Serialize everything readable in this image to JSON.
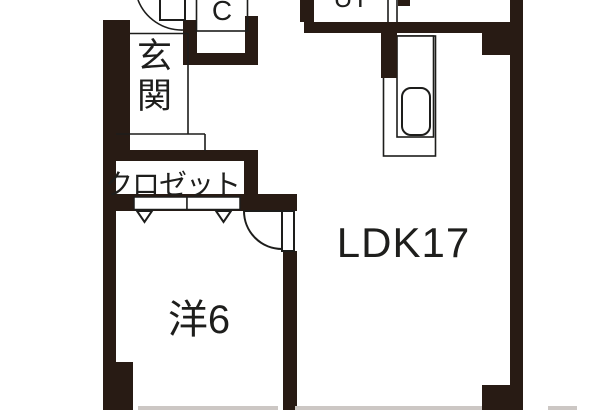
{
  "title": "apartment-floor-plan",
  "colors": {
    "wall": "#281b14",
    "line": "#1d1d1b",
    "window": "#ccc7c4",
    "floor": "#ffffff"
  },
  "rooms": {
    "genkan": {
      "label": "玄関"
    },
    "closet_c": {
      "label": "C"
    },
    "utility": {
      "label": "UT"
    },
    "closet": {
      "label": "クロゼット"
    },
    "western_room": {
      "label": "洋6"
    },
    "ldk": {
      "label": "LDK17"
    }
  },
  "fixtures": {
    "bathtub": "bathtub-icon",
    "entrance_door": "quarter-arc-door",
    "room_door": "quarter-arc-door",
    "closet_doors": "two-panel-doors-with-triangle-markers",
    "windows": "gray-sill-marks-bottom-edge"
  }
}
